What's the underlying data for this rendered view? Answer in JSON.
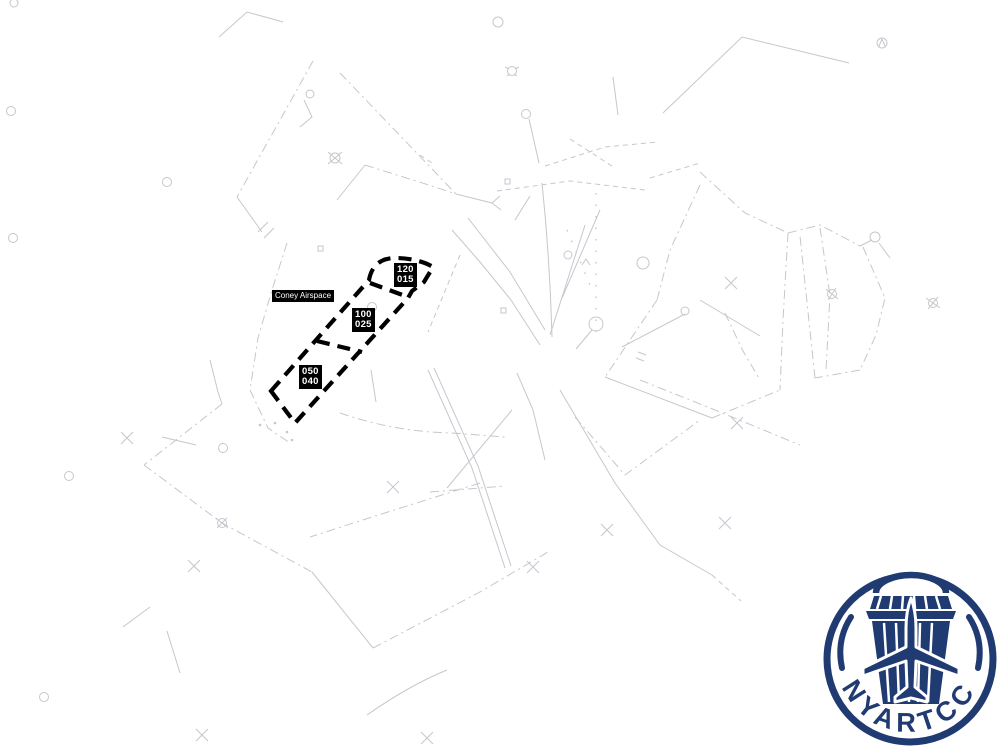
{
  "map": {
    "airspace_label": "Coney Airspace",
    "altitude_blocks": [
      {
        "name": "coney-high",
        "top": "120",
        "bottom": "015"
      },
      {
        "name": "coney-mid",
        "top": "100",
        "bottom": "025"
      },
      {
        "name": "coney-low",
        "top": "050",
        "bottom": "040"
      }
    ],
    "colors": {
      "background": "#ffffff",
      "boundary_lines": "#c6c7ce",
      "highlight_boundary": "#000000",
      "label_background": "#000000",
      "label_text": "#ffffff"
    }
  },
  "logo": {
    "text": "NYARTCC",
    "color": "#203a72",
    "icons": [
      "control-tower-icon",
      "airplane-icon"
    ]
  }
}
